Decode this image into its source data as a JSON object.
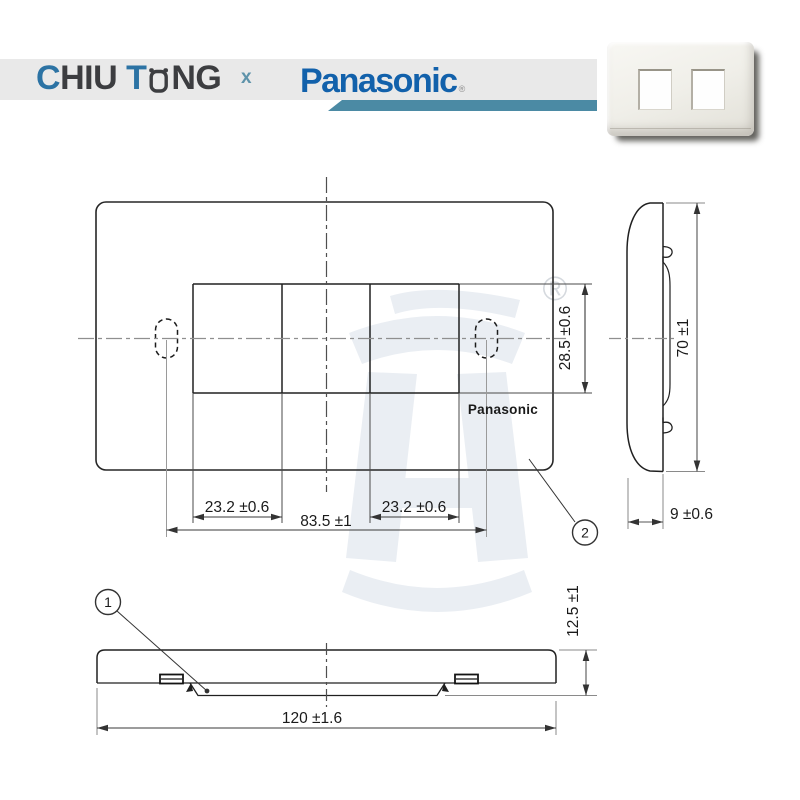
{
  "header": {
    "brand_left": {
      "part_blue1": "C",
      "part_dark1": "HIU ",
      "part_blue2": "T",
      "part_dark2": "NG"
    },
    "separator": "x",
    "brand_right": "Panasonic",
    "brand_right_reg": "®"
  },
  "colors": {
    "header_bar": "#e9e9e9",
    "accent_teal": "#4b8aa4",
    "brand_blue": "#2c73a4",
    "brand_dark": "#3c3d40",
    "panasonic_blue": "#1261ab",
    "watermark": "#eaeef3",
    "line_dark": "#262626",
    "centerline_gray": "#8f8f8f"
  },
  "drawing": {
    "plate_logo": "Panasonic",
    "registered_mark": "®",
    "callout_1": "1",
    "callout_2": "2",
    "dimensions": {
      "cutout_height": "28.5 ±0.6",
      "cutout_width_left": "23.2 ±0.6",
      "cutout_width_right": "23.2 ±0.6",
      "hole_spacing": "83.5 ±1",
      "plate_height": "70 ±1",
      "plate_depth": "9 ±0.6",
      "edge_height": "12.5 ±1",
      "plate_width": "120 ±1.6"
    }
  }
}
